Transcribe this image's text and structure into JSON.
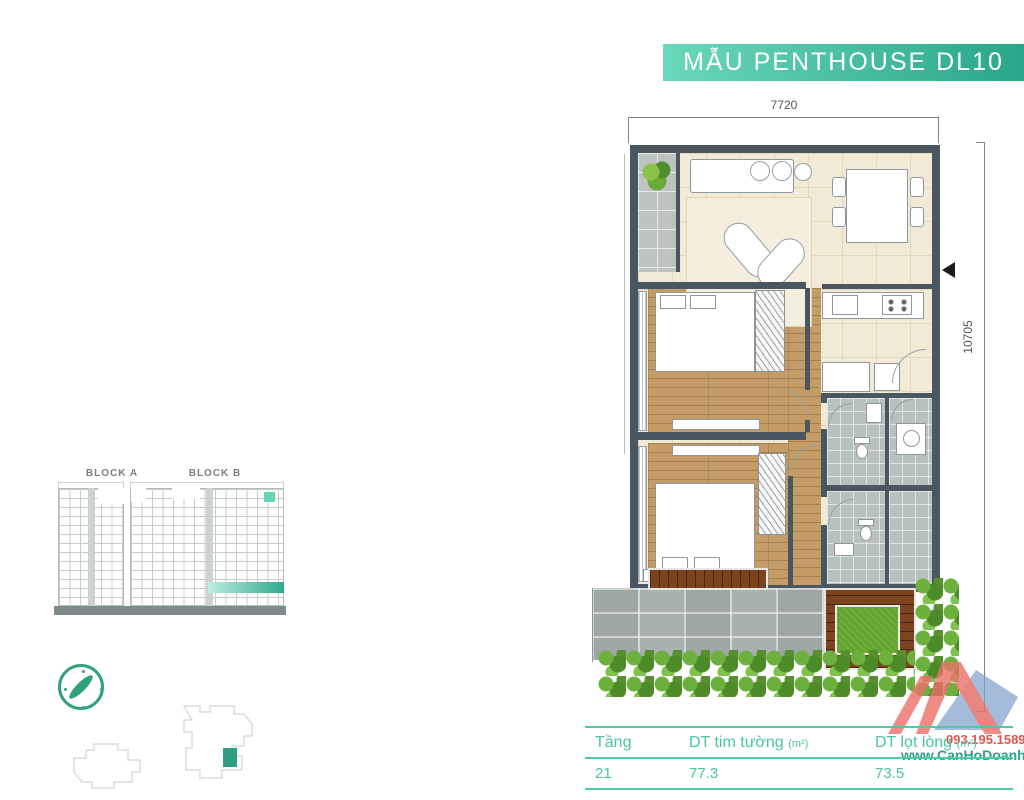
{
  "banner": {
    "title": "MẪU PENTHOUSE DL10"
  },
  "dimensions": {
    "top_width": "7720",
    "right_height": "10705"
  },
  "elevation": {
    "block_a": "BLOCK A",
    "block_b": "BLOCK B"
  },
  "icons": {
    "entrance_arrow": "◀",
    "compass": "compass-icon",
    "plant": "plant-icon"
  },
  "area_table": {
    "headers": [
      {
        "label": "Tầng",
        "unit": ""
      },
      {
        "label": "DT tim tường ",
        "unit": "(m²)"
      },
      {
        "label": "DT lọt lòng ",
        "unit": "(m²)"
      }
    ],
    "rows": [
      {
        "floor": "21",
        "gross": "77.3",
        "net": "73.5"
      }
    ]
  },
  "watermark": {
    "phone": "093.195.1589",
    "website": "www.CanHoDoanhNhan.com"
  },
  "colors": {
    "accent_teal": "#4ec9a8",
    "banner_from": "#6ad8ba",
    "banner_to": "#2aa68b",
    "wall": "#4a5761",
    "unit_highlight": "#2f9e84",
    "elevation_highlight": "#64d6b8",
    "phone_red": "#e2574c",
    "website_teal": "#2fa089",
    "logo_red": "#ea7168",
    "logo_blue": "#7e9fcc"
  }
}
